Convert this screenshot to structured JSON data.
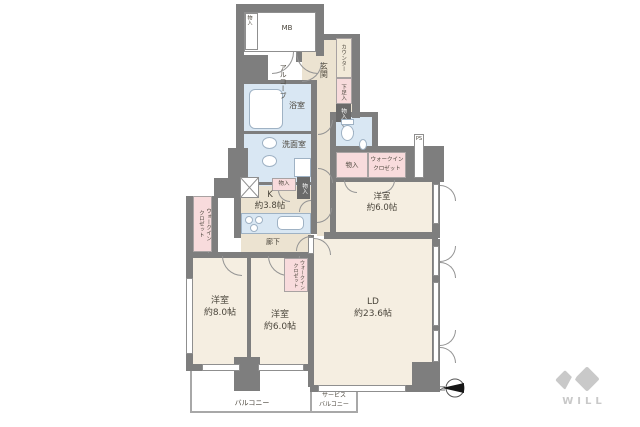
{
  "colors": {
    "wall": "#7e7e7e",
    "room_cream": "#f5eee1",
    "hall_beige": "#ece3d1",
    "water_blue": "#d9e7f3",
    "closet_pink": "#f8dbdc",
    "counter_cream": "#f2ead9",
    "dark_storage": "#6a6a6a",
    "balcony_line": "#a8a8a8",
    "text": "#4b463c",
    "logo_gray": "#c9c9c9"
  },
  "plan": {
    "mb": "MB",
    "trunk": "物入",
    "alcove": "アルコーブ",
    "entrance": "玄関",
    "counter": "カウンター",
    "shoe_box": "下足入",
    "entrance_storage": "物入",
    "bathroom": "浴室",
    "washroom": "洗面室",
    "toilet_storage": "物入",
    "wic_right_l1": "ウォークイン",
    "wic_right_l2": "クロゼット",
    "ps": "PS",
    "kitchen_storage_a": "物入",
    "kitchen_storage_b": "物入",
    "kitchen_name": "K",
    "kitchen_size": "約3.8帖",
    "corridor": "廊下",
    "wic_left_l1": "ウォークイン",
    "wic_left_l2": "クロゼット",
    "wic_mid_l1": "ウォークイン",
    "wic_mid_l2": "クロゼット",
    "bedroom_ne_name": "洋室",
    "bedroom_ne_size": "約6.0帖",
    "bedroom_sw_name": "洋室",
    "bedroom_sw_size": "約8.0帖",
    "bedroom_s_name": "洋室",
    "bedroom_s_size": "約6.0帖",
    "ld_name": "LD",
    "ld_size": "約23.6帖",
    "balcony": "バルコニー",
    "service_balcony_l1": "サービス",
    "service_balcony_l2": "バルコニー"
  },
  "compass": {
    "n": "N"
  },
  "logo": {
    "text": "WILL"
  }
}
